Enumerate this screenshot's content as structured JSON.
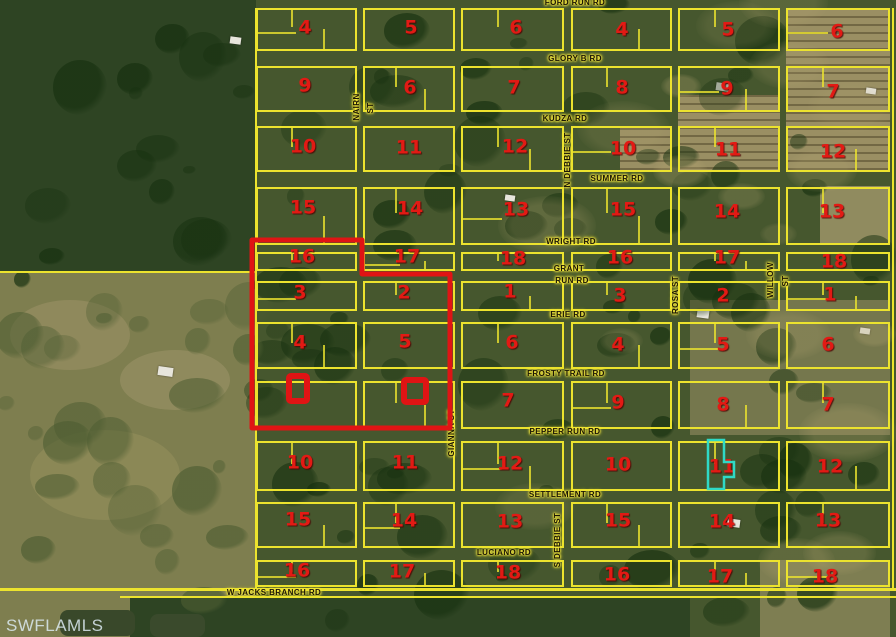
{
  "watermark": "SWFLAMLS",
  "colors": {
    "grid_yellow": "#ece32e",
    "block_number_red": "#e21a14",
    "selection_red": "#e01414",
    "highlight_teal": "#2fd9c6",
    "label_text": "#1a1504",
    "label_halo": "#f4e73e"
  },
  "road_labels": [
    {
      "text": "FORD RUN RD",
      "x": 575,
      "y": 3,
      "v": false
    },
    {
      "text": "GLORY B RD",
      "x": 575,
      "y": 59,
      "v": false
    },
    {
      "text": "KUDZA RD",
      "x": 565,
      "y": 119,
      "v": false
    },
    {
      "text": "SUMMER RD",
      "x": 617,
      "y": 179,
      "v": false
    },
    {
      "text": "WRIGHT RD",
      "x": 571,
      "y": 242,
      "v": false
    },
    {
      "text": "GRANT",
      "x": 569,
      "y": 269,
      "v": false
    },
    {
      "text": "RUN RD",
      "x": 572,
      "y": 281,
      "v": false
    },
    {
      "text": "ERIE RD",
      "x": 568,
      "y": 315,
      "v": false
    },
    {
      "text": "FROSTY TRAIL RD",
      "x": 566,
      "y": 374,
      "v": false
    },
    {
      "text": "PEPPER RUN RD",
      "x": 565,
      "y": 432,
      "v": false
    },
    {
      "text": "SETTLEMENT RD",
      "x": 565,
      "y": 495,
      "v": false
    },
    {
      "text": "LUCIANO RD",
      "x": 504,
      "y": 553,
      "v": false
    },
    {
      "text": "W JACKS BRANCH RD",
      "x": 274,
      "y": 593,
      "v": false
    },
    {
      "text": "NAIRN",
      "x": 357,
      "y": 107,
      "v": true
    },
    {
      "text": "ST",
      "x": 371,
      "y": 108,
      "v": true
    },
    {
      "text": "N DEBBIE ST",
      "x": 568,
      "y": 160,
      "v": true
    },
    {
      "text": "GIANNA ST",
      "x": 452,
      "y": 433,
      "v": true
    },
    {
      "text": "ROSA ST",
      "x": 676,
      "y": 295,
      "v": true
    },
    {
      "text": "WILLOW",
      "x": 771,
      "y": 280,
      "v": true
    },
    {
      "text": "ST",
      "x": 786,
      "y": 281,
      "v": true
    },
    {
      "text": "S DEBBIE ST",
      "x": 558,
      "y": 540,
      "v": true
    }
  ],
  "block_numbers": [
    {
      "text": "4",
      "x": 305,
      "y": 28
    },
    {
      "text": "5",
      "x": 411,
      "y": 28
    },
    {
      "text": "6",
      "x": 516,
      "y": 28
    },
    {
      "text": "4",
      "x": 622,
      "y": 30
    },
    {
      "text": "5",
      "x": 728,
      "y": 30
    },
    {
      "text": "6",
      "x": 837,
      "y": 32
    },
    {
      "text": "9",
      "x": 305,
      "y": 86
    },
    {
      "text": "6",
      "x": 410,
      "y": 88
    },
    {
      "text": "7",
      "x": 514,
      "y": 88
    },
    {
      "text": "8",
      "x": 622,
      "y": 88
    },
    {
      "text": "9",
      "x": 727,
      "y": 89
    },
    {
      "text": "7",
      "x": 833,
      "y": 92
    },
    {
      "text": "10",
      "x": 303,
      "y": 147
    },
    {
      "text": "11",
      "x": 409,
      "y": 148
    },
    {
      "text": "12",
      "x": 515,
      "y": 147
    },
    {
      "text": "10",
      "x": 623,
      "y": 149
    },
    {
      "text": "11",
      "x": 728,
      "y": 150
    },
    {
      "text": "12",
      "x": 833,
      "y": 152
    },
    {
      "text": "15",
      "x": 303,
      "y": 208
    },
    {
      "text": "14",
      "x": 410,
      "y": 209
    },
    {
      "text": "13",
      "x": 516,
      "y": 210
    },
    {
      "text": "15",
      "x": 623,
      "y": 210
    },
    {
      "text": "14",
      "x": 727,
      "y": 212
    },
    {
      "text": "13",
      "x": 832,
      "y": 212
    },
    {
      "text": "16",
      "x": 302,
      "y": 257
    },
    {
      "text": "17",
      "x": 407,
      "y": 257
    },
    {
      "text": "18",
      "x": 513,
      "y": 259
    },
    {
      "text": "16",
      "x": 620,
      "y": 258
    },
    {
      "text": "17",
      "x": 727,
      "y": 258
    },
    {
      "text": "18",
      "x": 834,
      "y": 262
    },
    {
      "text": "3",
      "x": 300,
      "y": 293
    },
    {
      "text": "2",
      "x": 404,
      "y": 293
    },
    {
      "text": "1",
      "x": 510,
      "y": 292
    },
    {
      "text": "3",
      "x": 620,
      "y": 296
    },
    {
      "text": "2",
      "x": 723,
      "y": 296
    },
    {
      "text": "1",
      "x": 830,
      "y": 295
    },
    {
      "text": "4",
      "x": 300,
      "y": 343
    },
    {
      "text": "5",
      "x": 405,
      "y": 342
    },
    {
      "text": "6",
      "x": 512,
      "y": 343
    },
    {
      "text": "4",
      "x": 618,
      "y": 345
    },
    {
      "text": "5",
      "x": 723,
      "y": 345
    },
    {
      "text": "6",
      "x": 828,
      "y": 345
    },
    {
      "text": "7",
      "x": 508,
      "y": 401
    },
    {
      "text": "9",
      "x": 618,
      "y": 403
    },
    {
      "text": "8",
      "x": 723,
      "y": 405
    },
    {
      "text": "7",
      "x": 828,
      "y": 405
    },
    {
      "text": "10",
      "x": 300,
      "y": 463
    },
    {
      "text": "11",
      "x": 405,
      "y": 463
    },
    {
      "text": "12",
      "x": 510,
      "y": 464
    },
    {
      "text": "10",
      "x": 618,
      "y": 465
    },
    {
      "text": "11",
      "x": 722,
      "y": 467
    },
    {
      "text": "12",
      "x": 830,
      "y": 467
    },
    {
      "text": "15",
      "x": 298,
      "y": 520
    },
    {
      "text": "14",
      "x": 404,
      "y": 521
    },
    {
      "text": "13",
      "x": 510,
      "y": 522
    },
    {
      "text": "15",
      "x": 618,
      "y": 521
    },
    {
      "text": "14",
      "x": 722,
      "y": 522
    },
    {
      "text": "13",
      "x": 828,
      "y": 521
    },
    {
      "text": "16",
      "x": 297,
      "y": 571
    },
    {
      "text": "17",
      "x": 402,
      "y": 572
    },
    {
      "text": "18",
      "x": 508,
      "y": 573
    },
    {
      "text": "16",
      "x": 617,
      "y": 575
    },
    {
      "text": "17",
      "x": 720,
      "y": 577
    },
    {
      "text": "18",
      "x": 825,
      "y": 577
    }
  ],
  "grid": {
    "cols": [
      [
        256,
        357
      ],
      [
        363,
        455
      ],
      [
        461,
        564
      ],
      [
        571,
        672
      ],
      [
        678,
        780
      ],
      [
        786,
        890
      ]
    ],
    "rows": [
      [
        8,
        51
      ],
      [
        66,
        112
      ],
      [
        126,
        172
      ],
      [
        187,
        245
      ],
      [
        252,
        271
      ],
      [
        281,
        311
      ],
      [
        322,
        369
      ],
      [
        381,
        429
      ],
      [
        441,
        491
      ],
      [
        502,
        548
      ],
      [
        560,
        587
      ]
    ]
  },
  "extra_lines": [
    {
      "x": 0,
      "y": 271,
      "w": 256,
      "h": 2
    },
    {
      "x": 255,
      "y": 8,
      "w": 2,
      "h": 580
    },
    {
      "x": 0,
      "y": 588,
      "w": 896,
      "h": 3
    },
    {
      "x": 120,
      "y": 596,
      "w": 776,
      "h": 2
    },
    {
      "x": 892,
      "y": 8,
      "w": 2,
      "h": 580
    }
  ],
  "overlays": {
    "selection_polygon": "252,240 362,240 362,274 450,274 450,428 252,428",
    "marker_squares": [
      {
        "x": 289,
        "y": 376,
        "w": 18,
        "h": 25
      },
      {
        "x": 404,
        "y": 380,
        "w": 22,
        "h": 22
      }
    ],
    "teal_path": "M708,440 H724 V462 H734 V477 H724 V489 H708 Z"
  }
}
